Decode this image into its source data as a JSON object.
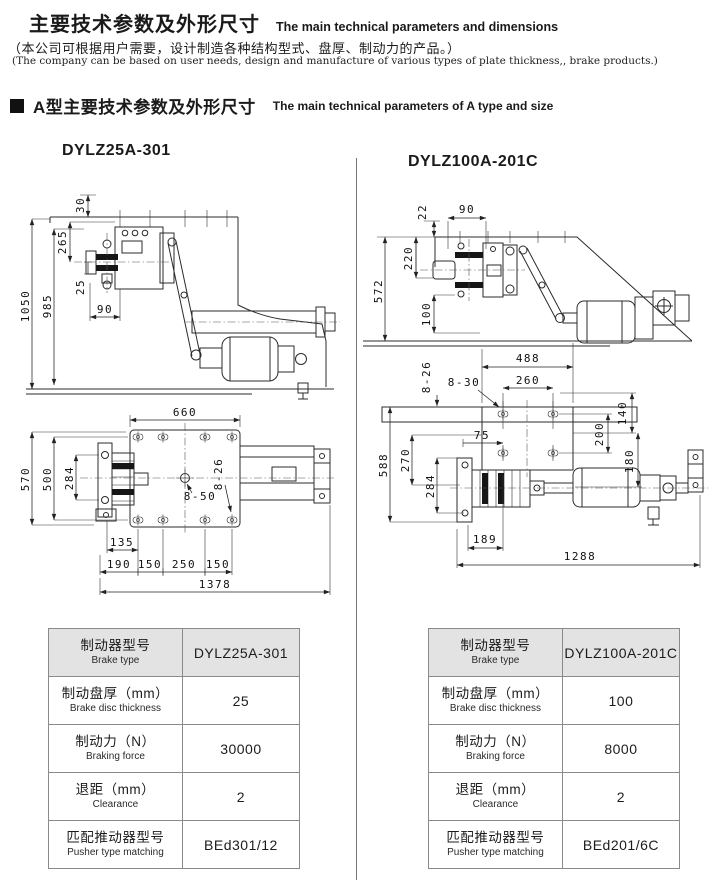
{
  "header": {
    "title_zh": "主要技术参数及外形尺寸",
    "title_en": "The main technical parameters and dimensions",
    "note_zh": "（本公司可根据用户需要，设计制造各种结构型式、盘厚、制动力的产品。）",
    "note_en": "(The company can be based on user needs, design and manufacture of various types of plate thickness,, brake products.)",
    "section_zh": "A型主要技术参数及外形尺寸",
    "section_en": "The main technical parameters of A type and size"
  },
  "drawings": {
    "left": {
      "model": "DYLZ25A-301",
      "side": {
        "offset_top": "30",
        "upper_span": "265",
        "pad_gap": "25",
        "hole_pitch": "90",
        "overall_height": "1050",
        "frame_height": "985"
      },
      "plan": {
        "plate_width": "660",
        "overall_depth": "570",
        "frame_depth": "500",
        "caliper_span": "284",
        "center_holes": "8-50",
        "side_holes": "8-26",
        "offset_a": "135",
        "offset_b": "190",
        "pitch_a": "150",
        "pitch_b": "250",
        "pitch_c": "150",
        "overall_length": "1378"
      }
    },
    "right": {
      "model": "DYLZ100A-201C",
      "side": {
        "offset_top": "22",
        "hole_pitch": "90",
        "upper_span": "220",
        "pad_gap": "100",
        "overall_height": "572",
        "base_width": "488"
      },
      "plan": {
        "side_holes": "8-26",
        "slot_holes": "8-30",
        "hole_span": "260",
        "hole_offset": "75",
        "pitch_b": "140",
        "pitch_a": "200",
        "pitch_c": "180",
        "overall_depth": "588",
        "frame_depth": "270",
        "caliper_span": "284",
        "offset_a": "189",
        "overall_length": "1288"
      }
    }
  },
  "tables": {
    "left": {
      "rows": [
        {
          "zh": "制动器型号",
          "en": "Brake type",
          "value": "DYLZ25A-301"
        },
        {
          "zh": "制动盘厚（mm）",
          "en": "Brake disc thickness",
          "value": "25"
        },
        {
          "zh": "制动力（N）",
          "en": "Braking force",
          "value": "30000"
        },
        {
          "zh": "退距（mm）",
          "en": "Clearance",
          "value": "2"
        },
        {
          "zh": "匹配推动器型号",
          "en": "Pusher type matching",
          "value": "BEd301/12"
        }
      ]
    },
    "right": {
      "rows": [
        {
          "zh": "制动器型号",
          "en": "Brake type",
          "value": "DYLZ100A-201C"
        },
        {
          "zh": "制动盘厚（mm）",
          "en": "Brake disc thickness",
          "value": "100"
        },
        {
          "zh": "制动力（N）",
          "en": "Braking force",
          "value": "8000"
        },
        {
          "zh": "退距（mm）",
          "en": "Clearance",
          "value": "2"
        },
        {
          "zh": "匹配推动器型号",
          "en": "Pusher type matching",
          "value": "BEd201/6C"
        }
      ]
    }
  }
}
